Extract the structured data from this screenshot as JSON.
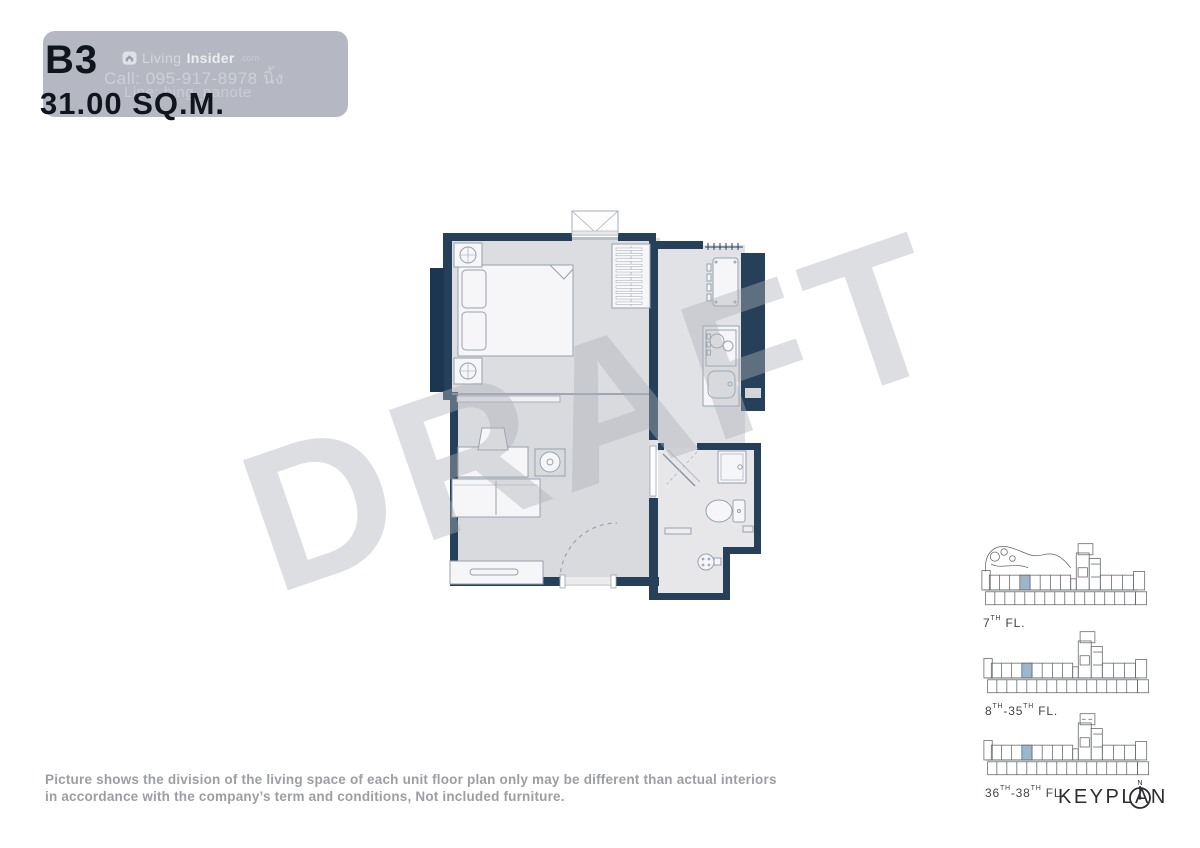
{
  "header": {
    "unit_code": "B3",
    "area": "31.00 SQ.M.",
    "badge_bg": "#b5b8c2",
    "logo": {
      "brand_light": "Living",
      "brand_bold": "Insider",
      "brand_suffix": ".com"
    },
    "contact_call": "Call: 095-917-8978 นิ้ง",
    "contact_line": "Line: bing_panote"
  },
  "watermark": {
    "text": "DRAFT",
    "color": "rgba(175,177,183,0.42)"
  },
  "floorplan": {
    "wall_color": "#254058",
    "window_block_color": "#1d3650",
    "floor_color": "#dcdde0",
    "corridor_floor_color": "#e1e2e5",
    "bathroom_floor_color": "#e7e7ea",
    "furniture_fill": "#f6f6f8",
    "furniture_stroke": "#97a1ad"
  },
  "keyplan": {
    "title": "KEYPLAN",
    "highlight_color": "#9db6cb",
    "floors": [
      {
        "variant": "garden",
        "label_parts": [
          {
            "t": "7",
            "sup": false
          },
          {
            "t": "TH",
            "sup": true
          },
          {
            "t": " FL.",
            "sup": false
          }
        ]
      },
      {
        "variant": "plain",
        "label_parts": [
          {
            "t": "8",
            "sup": false
          },
          {
            "t": "TH",
            "sup": true
          },
          {
            "t": "-35",
            "sup": false
          },
          {
            "t": "TH",
            "sup": true
          },
          {
            "t": " FL.",
            "sup": false
          }
        ]
      },
      {
        "variant": "dash",
        "label_parts": [
          {
            "t": "36",
            "sup": false
          },
          {
            "t": "TH",
            "sup": true
          },
          {
            "t": "-38",
            "sup": false
          },
          {
            "t": "TH",
            "sup": true
          },
          {
            "t": " FL.",
            "sup": false
          }
        ]
      }
    ]
  },
  "disclaimer": {
    "lines": [
      "Picture shows the division of the living space of each unit floor plan only may be different than actual interiors",
      "in accordance with the company’s term and conditions, Not included furniture."
    ]
  }
}
